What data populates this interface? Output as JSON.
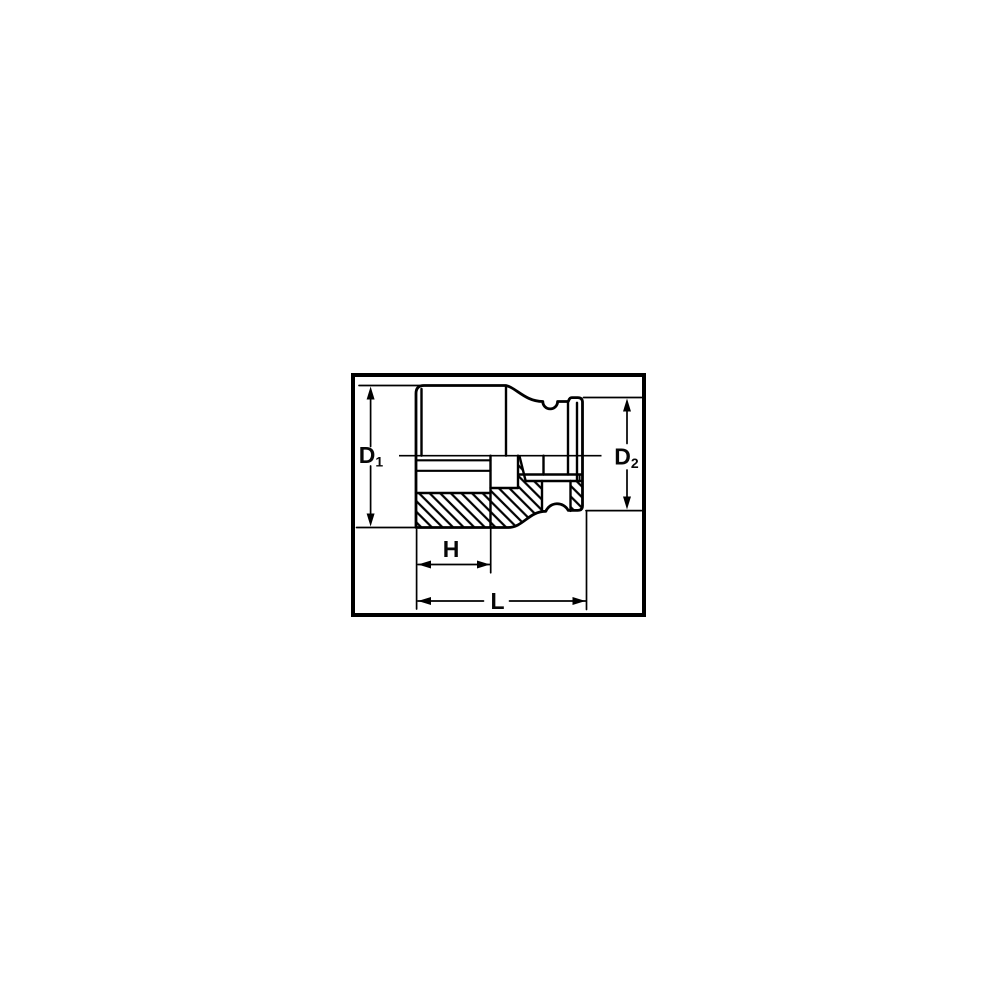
{
  "diagram": {
    "description": "socket cross-section dimension drawing",
    "labels": {
      "d1": {
        "base": "D",
        "sub": "1"
      },
      "d2": {
        "base": "D",
        "sub": "2"
      },
      "h": "H",
      "l": "L"
    },
    "colors": {
      "line": "#000000",
      "background": "#ffffff"
    }
  }
}
